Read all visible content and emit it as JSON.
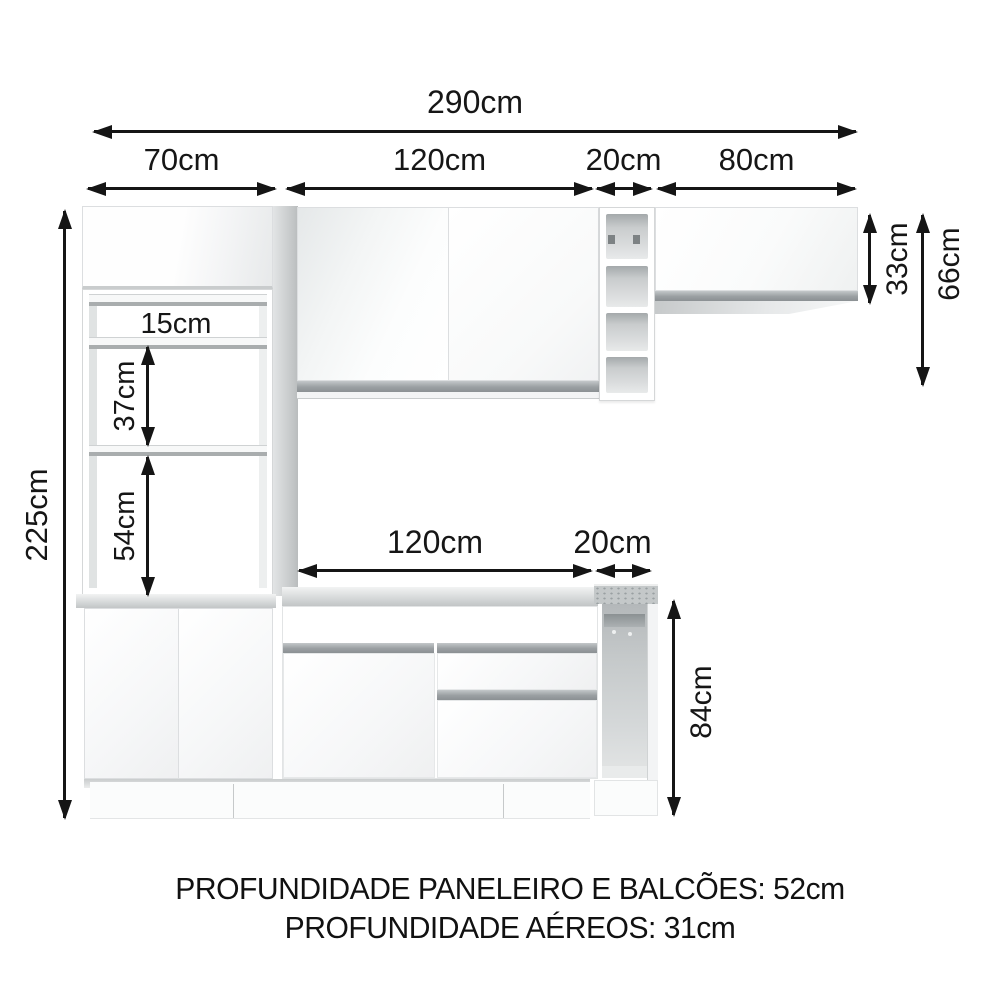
{
  "diagram": {
    "dims": {
      "total_width": "290cm",
      "paneleiro_width": "70cm",
      "aereo_width": "120cm",
      "nicho_width": "20cm",
      "aereo_right_width": "80cm",
      "total_height": "225cm",
      "shelf_gap_top": "15cm",
      "shelf_gap_mid": "37cm",
      "shelf_gap_bottom": "54cm",
      "balcao_width": "120cm",
      "balcao_nicho_width": "20cm",
      "aereo_door_height": "33cm",
      "aereo_total_height": "66cm",
      "balcao_height": "84cm"
    },
    "footer": {
      "line1": "PROFUNDIDADE PANELEIRO E BALCÕES: 52cm",
      "line2": "PROFUNDIDADE AÉREOS: 31cm"
    },
    "colors": {
      "text": "#141414",
      "handle_profile": "#8f9496",
      "countertop": "#c6c9ca"
    }
  }
}
